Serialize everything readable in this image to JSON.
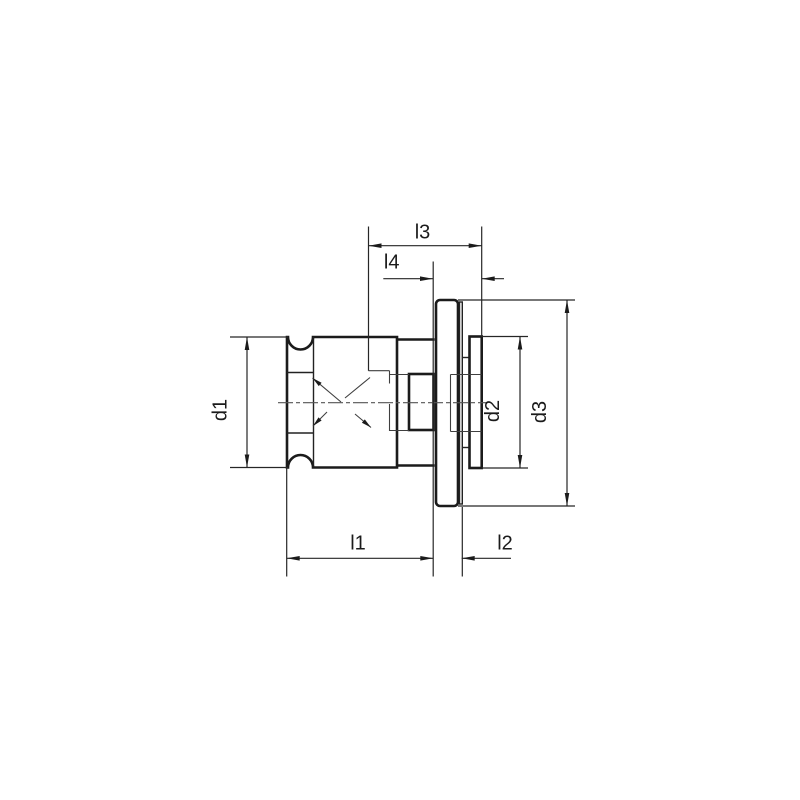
{
  "drawing": {
    "labels": {
      "l1": "l1",
      "l2": "l2",
      "l3": "l3",
      "l4": "l4",
      "d1": "d1",
      "d2": "d2",
      "d3": "d3"
    },
    "colors": {
      "background": "#ffffff",
      "line": "#1b1b1b",
      "dimension_line": "#262626",
      "centerline": "#555555"
    }
  }
}
